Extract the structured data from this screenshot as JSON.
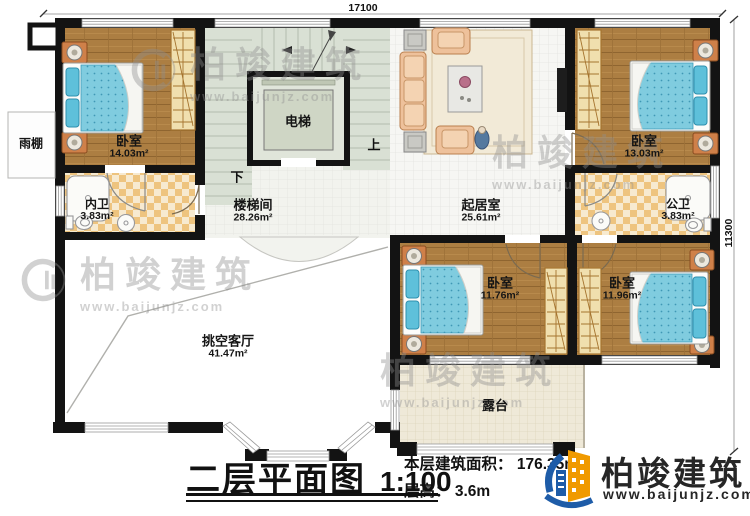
{
  "plan": {
    "dimension_top": "17100",
    "dimension_right": "11300",
    "stair_up": "上",
    "stair_down": "下"
  },
  "rooms": {
    "bedroom1": {
      "name": "卧室",
      "area": "14.03m²"
    },
    "inner_bath": {
      "name": "内卫",
      "area": "3.83m²"
    },
    "elevator": {
      "name": "电梯"
    },
    "stairwell": {
      "name": "楼梯间",
      "area": "28.26m²"
    },
    "living": {
      "name": "起居室",
      "area": "25.61m²"
    },
    "bedroom2": {
      "name": "卧室",
      "area": "13.03m²"
    },
    "public_bath": {
      "name": "公卫",
      "area": "3.83m²"
    },
    "bedroom3": {
      "name": "卧室",
      "area": "11.76m²"
    },
    "bedroom4": {
      "name": "卧室",
      "area": "11.96m²"
    },
    "void_living": {
      "name": "挑空客厅",
      "area": "41.47m²"
    },
    "terrace": {
      "name": "露台"
    },
    "canopy": {
      "name": "雨棚"
    }
  },
  "footer": {
    "title": "二层平面图",
    "scale": "1:100",
    "area_label": "本层建筑面积：",
    "area_value": "176.35m²",
    "height_label": "层高：",
    "height_value": "3.6m"
  },
  "branding": {
    "company": "柏竣建筑",
    "website": "www.baijunjz.com",
    "colors": {
      "brand_blue": "#1e5ca8",
      "brand_orange": "#f09a00",
      "wall": "#131313",
      "wood_floor": "#ac7e42",
      "mattress_blue": "#80ccdf",
      "bath_tile": "#eec47f",
      "stair_tread": "#d9e0d4"
    }
  }
}
